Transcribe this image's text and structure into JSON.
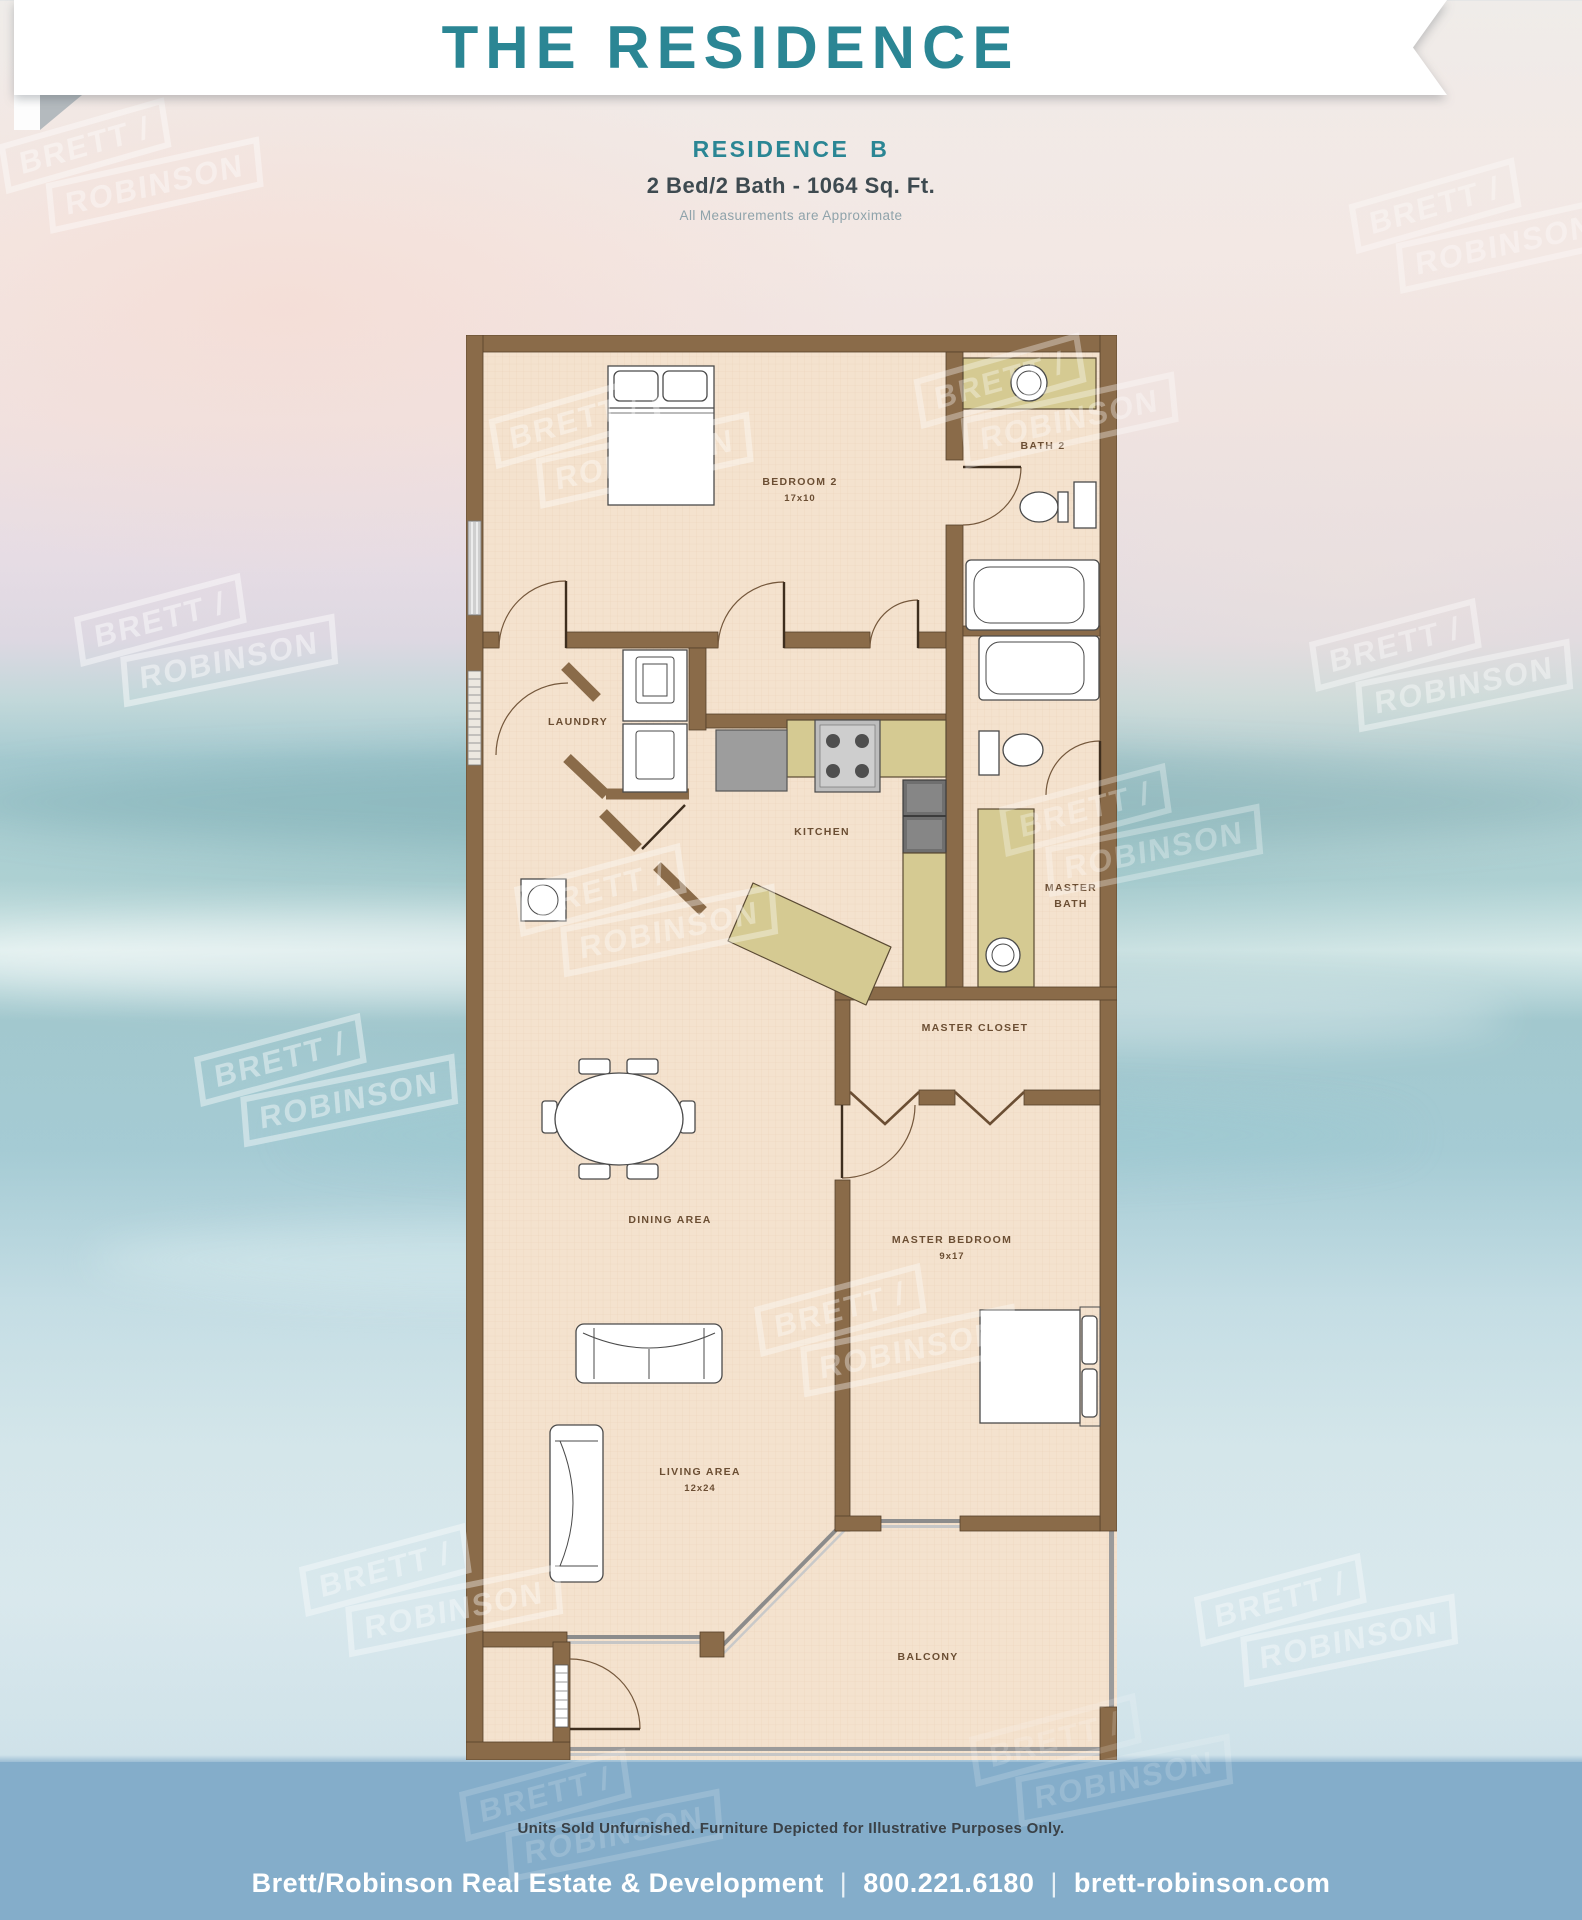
{
  "header": {
    "title": "THE RESIDENCE",
    "subtitle": "RESIDENCE B",
    "specs": "2 Bed/2 Bath - 1064 Sq. Ft.",
    "note": "All Measurements are Approximate",
    "accent_color": "#2B8694"
  },
  "floorplan": {
    "labels": {
      "bedroom2": "BEDROOM 2",
      "bedroom2_dims": "17x10",
      "bath2": "BATH 2",
      "laundry": "LAUNDRY",
      "kitchen": "KITCHEN",
      "master_bath_line1": "MASTER",
      "master_bath_line2": "BATH",
      "master_closet": "MASTER CLOSET",
      "dining": "DINING AREA",
      "master_bedroom": "MASTER BEDROOM",
      "master_bedroom_dims": "9x17",
      "living": "LIVING AREA",
      "living_dims": "12x24",
      "balcony": "BALCONY"
    },
    "colors": {
      "wall": "#8A6B49",
      "floor": "#F4E2CE",
      "grid": "#E8CFB6",
      "counter": "#D5CA92",
      "appliance": "#9B9B9B",
      "label": "#6B4E33"
    }
  },
  "watermark": {
    "line1": "BRETT /",
    "line2": "ROBINSON"
  },
  "footer": {
    "disclaimer": "Units Sold Unfurnished. Furniture Depicted for Illustrative Purposes Only.",
    "company": "Brett/Robinson Real Estate & Development",
    "phone": "800.221.6180",
    "website": "brett-robinson.com",
    "separator": "|",
    "band_color": "#84ADCA"
  }
}
